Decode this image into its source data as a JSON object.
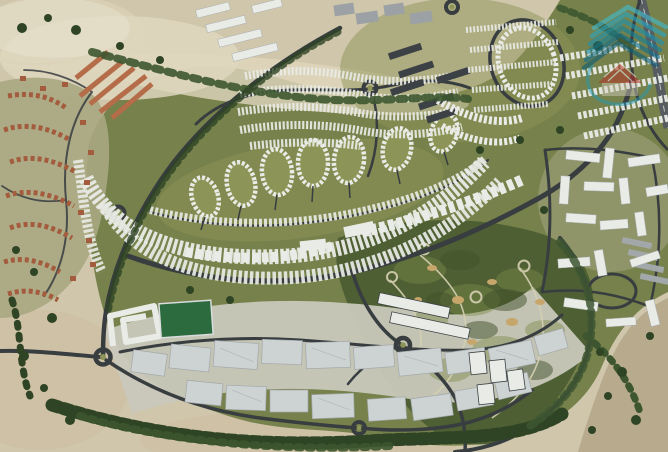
{
  "scene": {
    "type": "aerial-masterplan-render",
    "description": "3D aerial render of a desert master-planned community: crescent of white apartment arcs around teardrop residential clusters, dense townhouse field to the north, golf course to the south-east, warehouse zone along the south, terracotta villa district on the west edge, highway at the top-right, all surrounded by sand with scattered trees. Semi-transparent teal-and-red real-estate watermark logo in the top-right.",
    "regions": [
      "desert-outskirts",
      "villa-district-west",
      "terracotta-row-housing",
      "crescent-apartment-arcs",
      "teardrop-residential-clusters",
      "townhouse-field",
      "central-park-band",
      "golf-course",
      "warehouse-logistics-zone",
      "sports-field",
      "office-slabs",
      "right-bank-apartment-district",
      "north-east-loop-park",
      "highway-north-east",
      "tree-lined-boulevard",
      "roundabouts",
      "watermark-logo"
    ]
  },
  "palette": {
    "sand_base": "#cfc6ab",
    "sand_light": "#ded6bd",
    "sand_pink": "#cdbca1",
    "desert_dusty": "#b7aa8d",
    "green_main": "#76814b",
    "green_park": "#8d9457",
    "villa_ground": "#a9a782",
    "right_ground": "#a7aa87",
    "wh_ground": "#c9c8ba",
    "golf_dark": "#4e5f33",
    "golf_deep": "#42512b",
    "golf_light": "#7c8a4a",
    "tree_dark": "#2e4424",
    "tree_mid": "#3d5630",
    "road_dark": "#383d40",
    "road_light": "#565c60",
    "lane_white": "#d9dcdc",
    "building_white": "#e9ebe6",
    "building_shadow": "#a9afb1",
    "building_gray": "#9ba1a4",
    "dark_roof": "#3b4145",
    "terracotta": "#a35c3e",
    "terracotta_light": "#b46c49",
    "warehouse": "#cdd2d3",
    "warehouse_edge": "#a2a8aa",
    "field_green": "#2c6b3d",
    "path_sand": "#d6d1b4",
    "bunker": "#c7a66c",
    "haze": "#eae4d2"
  },
  "watermark": {
    "teal_1": "#3fbdd6",
    "teal_2": "#27a8c6",
    "teal_3": "#1a93b3",
    "teal_4": "#11819f",
    "teal_5": "#0d6e8e",
    "teal_6": "#0a5c77",
    "swoosh": "#1d9ab8",
    "roof_red": "#b23227",
    "stripe_white": "#e9e5dd",
    "house_body": "#d8d2c4",
    "opacity": "0.6"
  }
}
